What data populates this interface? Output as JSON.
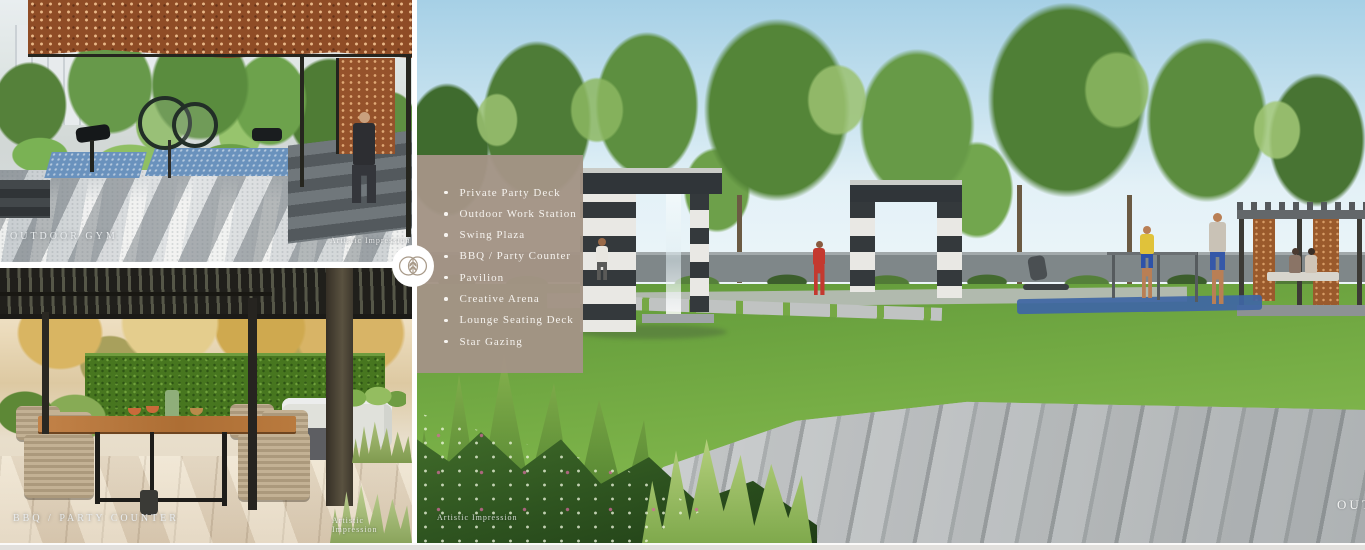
{
  "captions": {
    "outdoor_gym": "OUTDOOR GYM",
    "bbq_party_counter": "BBQ / PARTY COUNTER",
    "corner_partial": "OUT"
  },
  "credits": {
    "outdoor_gym": "Artistic Impression",
    "bbq_party_counter": "Artistic Impression",
    "main": "Artistic Impression"
  },
  "amenities": {
    "items": [
      "Private Party Deck",
      "Outdoor Work Station",
      "Swing Plaza",
      "BBQ / Party Counter",
      "Pavilion",
      "Creative Arena",
      "Lounge Seating Deck",
      "Star Gazing"
    ]
  },
  "badge": {
    "icon": "leaf-venn-logo"
  },
  "colors": {
    "panel": "#a39485",
    "sky": "#a6d0e6",
    "lawn": "#76ad45",
    "canopy_rust": "#8f4c26"
  }
}
